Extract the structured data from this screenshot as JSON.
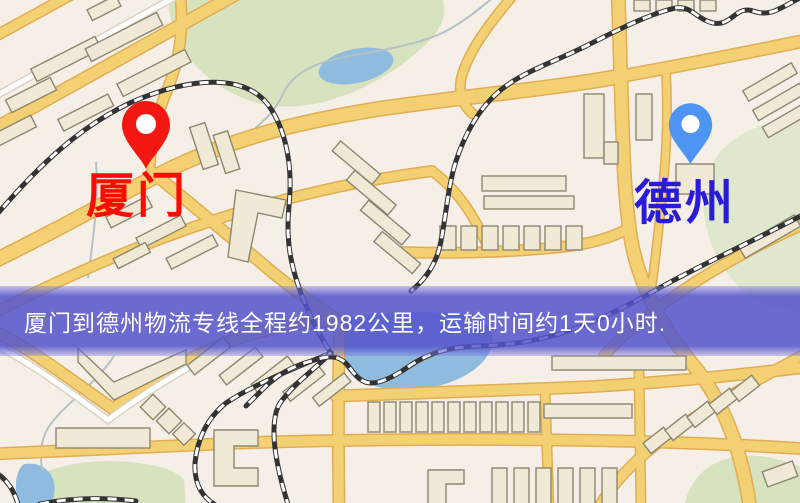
{
  "banner": {
    "text": "厦门到德州物流专线全程约1982公里，运输时间约1天0小时.",
    "distance_km": "1982",
    "duration": "1天0小时",
    "background_color": "#5353cb",
    "text_color": "#ffffff"
  },
  "markers": {
    "origin": {
      "label": "厦门",
      "pin_icon": "red-map-pin-icon",
      "pin_color": "#f31712",
      "label_color": "#fb0b04"
    },
    "destination": {
      "label": "德州",
      "pin_icon": "blue-map-pin-icon",
      "pin_color": "#4e95f3",
      "label_color": "#2a1bd8"
    }
  },
  "map_theme": {
    "background": "#f6efe7",
    "road_fill": "#f3d172",
    "road_casing": "#e0ad55",
    "park_green": "#d7e2bf",
    "water_blue": "#8fbbde",
    "building_fill": "#f0e9d6",
    "building_outline": "#8c8770",
    "railway_black": "#333333"
  }
}
